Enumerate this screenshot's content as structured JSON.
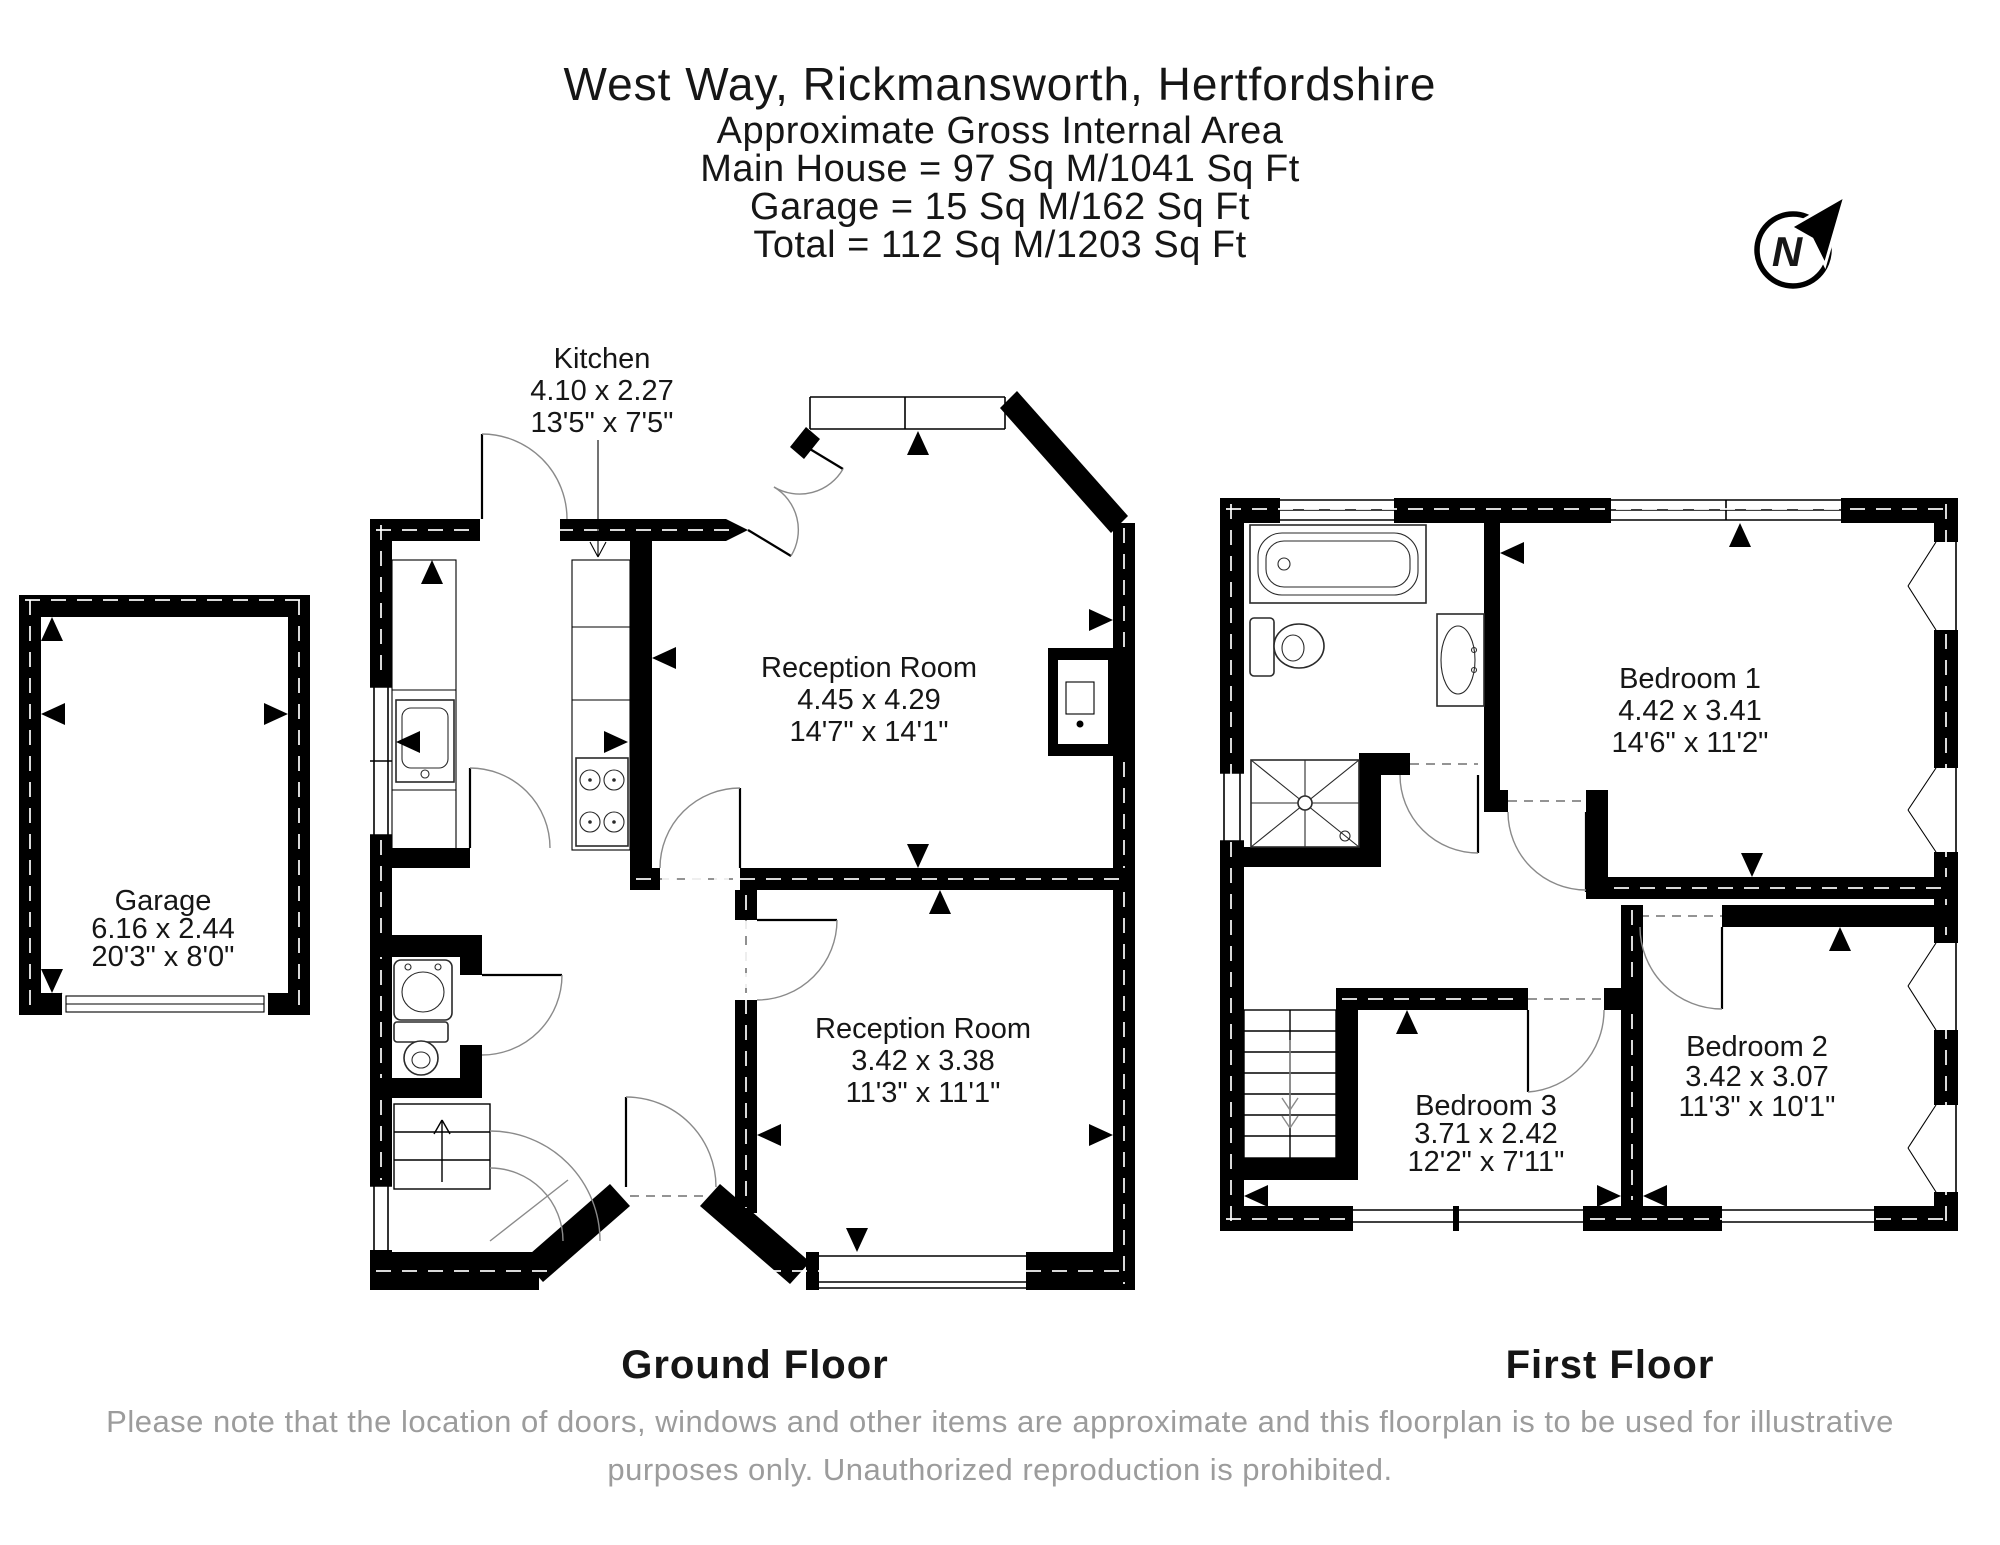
{
  "title": {
    "address": "West Way, Rickmansworth, Hertfordshire",
    "subtitle": "Approximate Gross Internal Area",
    "main_house_area": "Main House = 97 Sq M/1041 Sq Ft",
    "garage_area": "Garage = 15 Sq M/162 Sq Ft",
    "total_area": "Total = 112 Sq M/1203 Sq Ft"
  },
  "compass": {
    "north_label": "N"
  },
  "ground_floor": {
    "floor_label": "Ground Floor",
    "rooms": [
      {
        "name": "Garage",
        "metric": "6.16 x 2.44",
        "imperial": "20'3\" x 8'0\""
      },
      {
        "name": "Kitchen",
        "metric": "4.10 x 2.27",
        "imperial": "13'5\" x 7'5\""
      },
      {
        "name": "Reception Room",
        "metric": "4.45 x 4.29",
        "imperial": "14'7\" x 14'1\""
      },
      {
        "name": "Reception Room",
        "metric": "3.42 x 3.38",
        "imperial": "11'3\" x 11'1\""
      }
    ]
  },
  "first_floor": {
    "floor_label": "First Floor",
    "rooms": [
      {
        "name": "Bedroom 1",
        "metric": "4.42 x 3.41",
        "imperial": "14'6\" x 11'2\""
      },
      {
        "name": "Bedroom 2",
        "metric": "3.42 x 3.07",
        "imperial": "11'3\" x 10'1\""
      },
      {
        "name": "Bedroom 3",
        "metric": "3.71 x 2.42",
        "imperial": "12'2\" x 7'11\""
      }
    ]
  },
  "footer": {
    "disclaimer_line1": "Please note that the location of doors, windows and other items are approximate and this floorplan is to be used for illustrative",
    "disclaimer_line2": "purposes only. Unauthorized reproduction is prohibited."
  },
  "colors": {
    "wall": "#000000",
    "text": "#161616",
    "disclaimer": "#9c9c9c",
    "background": "#ffffff"
  }
}
